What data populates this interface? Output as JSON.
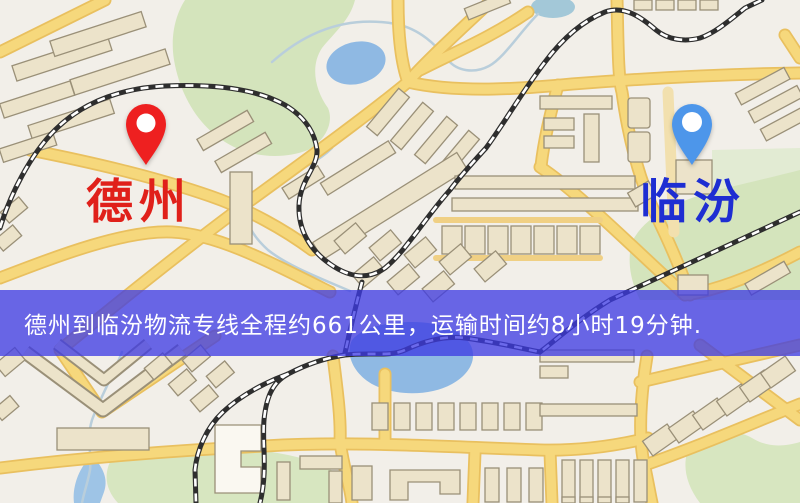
{
  "map": {
    "markers": [
      {
        "id": "origin",
        "label": "德州",
        "label_color": "#e0201a",
        "pin_color": "#ee2020"
      },
      {
        "id": "destination",
        "label": "临汾",
        "label_color": "#1e2ed2",
        "pin_color": "#4d96ea"
      }
    ],
    "colors": {
      "background": "#f2efe9",
      "road": "#f6d87c",
      "water": "#8fb9e3",
      "park": "#d4e4bc",
      "railway": "#2e2e2e",
      "building": "#ece3ca"
    }
  },
  "banner": {
    "text": "德州到临汾物流专线全程约661公里，运输时间约8小时19分钟.",
    "background_color": "#3c3ae3",
    "text_color": "#ffffff"
  },
  "route": {
    "origin": "德州",
    "destination": "临汾",
    "distance_text": "约661公里",
    "duration_text": "约8小时19分钟"
  }
}
